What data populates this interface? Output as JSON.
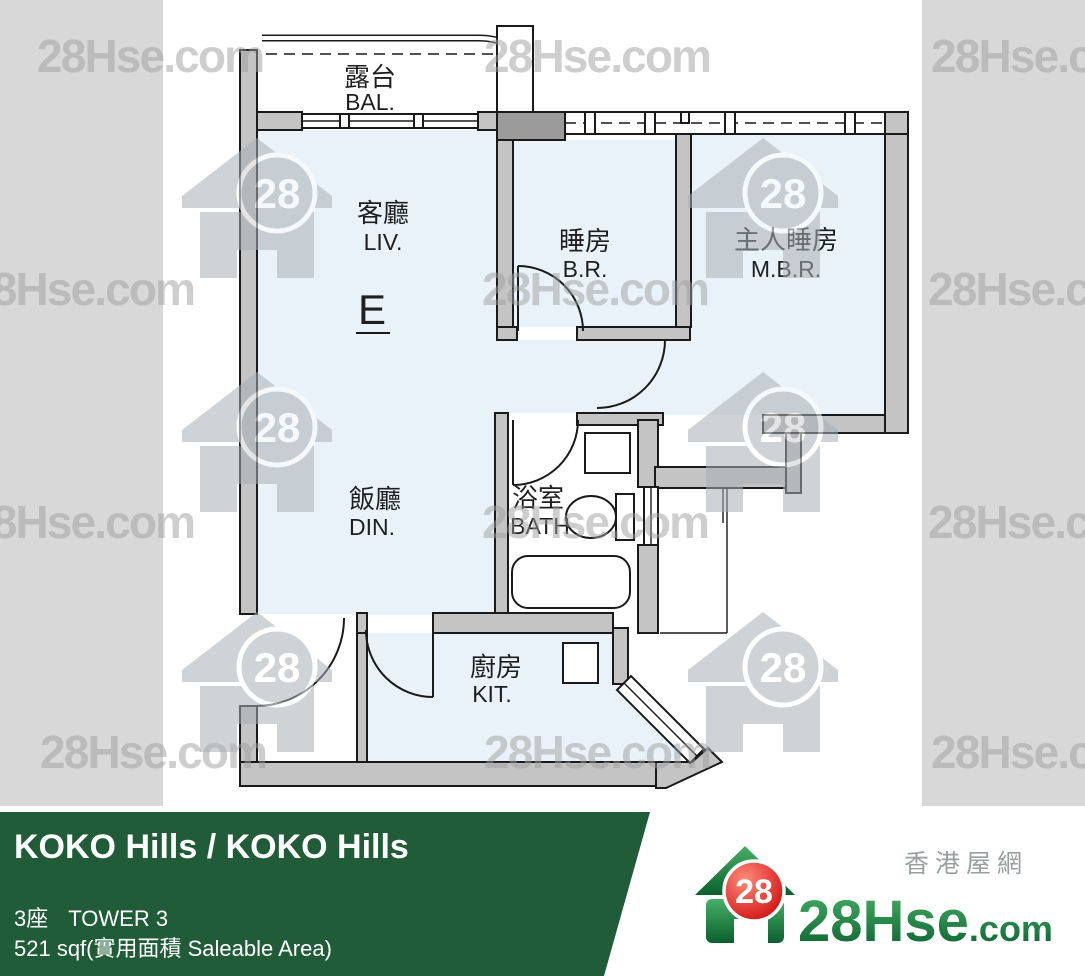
{
  "watermark": {
    "text": "28Hse.com",
    "badge": "28"
  },
  "plan": {
    "unit_label": "E",
    "rooms": [
      {
        "id": "balcony",
        "zh": "露台",
        "en": "BAL."
      },
      {
        "id": "living",
        "zh": "客廳",
        "en": "LIV."
      },
      {
        "id": "bedroom",
        "zh": "睡房",
        "en": "B.R."
      },
      {
        "id": "master-bedroom",
        "zh": "主人睡房",
        "en": "M.B.R."
      },
      {
        "id": "dining",
        "zh": "飯廳",
        "en": "DIN."
      },
      {
        "id": "bathroom",
        "zh": "浴室",
        "en": "BATH"
      },
      {
        "id": "kitchen",
        "zh": "廚房",
        "en": "KIT."
      }
    ]
  },
  "footer": {
    "title": "KOKO Hills / KOKO Hills",
    "tower_zh": "3座",
    "tower_en": "TOWER 3",
    "area": "521 sqf(實用面積 Saleable Area)",
    "banner_color": "#215c39"
  },
  "logo": {
    "icon": "house-icon",
    "badge": "28",
    "site": "28Hse",
    "domain": ".com",
    "tagline": "香港屋網"
  }
}
